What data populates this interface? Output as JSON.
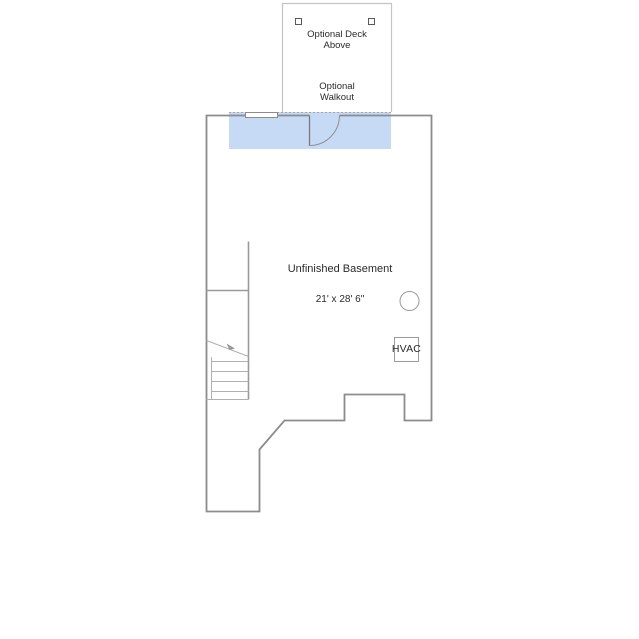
{
  "page": {
    "background_color": "#ffffff"
  },
  "floor_plan": {
    "room": {
      "name": "Unfinished Basement",
      "dimensions": "21' x 28' 6\""
    },
    "deck": {
      "label": "Optional Deck\nAbove"
    },
    "walkout": {
      "label": "Optional\nWalkout"
    },
    "hvac": {
      "label": "HVAC"
    },
    "colors": {
      "wall": "#8c8c8c",
      "interior-line": "#b0b0b0",
      "deck-border": "#c4c4c4",
      "highlight": "#c7daf5",
      "text": "#2b2b2b"
    }
  }
}
